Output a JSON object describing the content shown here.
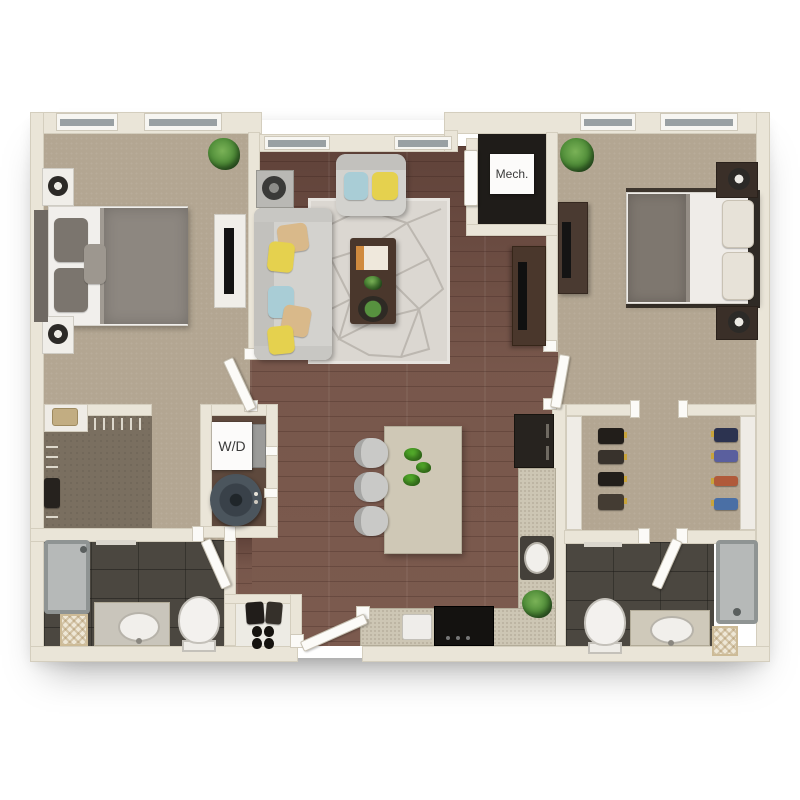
{
  "type": "floor_plan",
  "labels": {
    "mech_closet": "Mech.",
    "laundry_closet": "W/D"
  },
  "palette": {
    "background": "#ffffff",
    "wall": "#eae5d8",
    "wall_edge": "#d4cebe",
    "carpet": "#b3a692",
    "closet_carpet": "#7a6f60",
    "wood_floor": "#7b5a4e",
    "bath_tile": "#4b4740",
    "mech_floor": "#1f1c19",
    "window_glass": "#99a0a3",
    "counter": "#cdc6b4",
    "sofa_gray": "#d3d2ce",
    "duvet_gray": "#8d8780",
    "dark_furniture": "#3e332b",
    "accent_yellow": "#e5d14e",
    "accent_blue": "#a9cdd6",
    "plant_green": "#4c8a36",
    "appliance_black": "#141210",
    "shower_gray": "#b6b9b8"
  }
}
